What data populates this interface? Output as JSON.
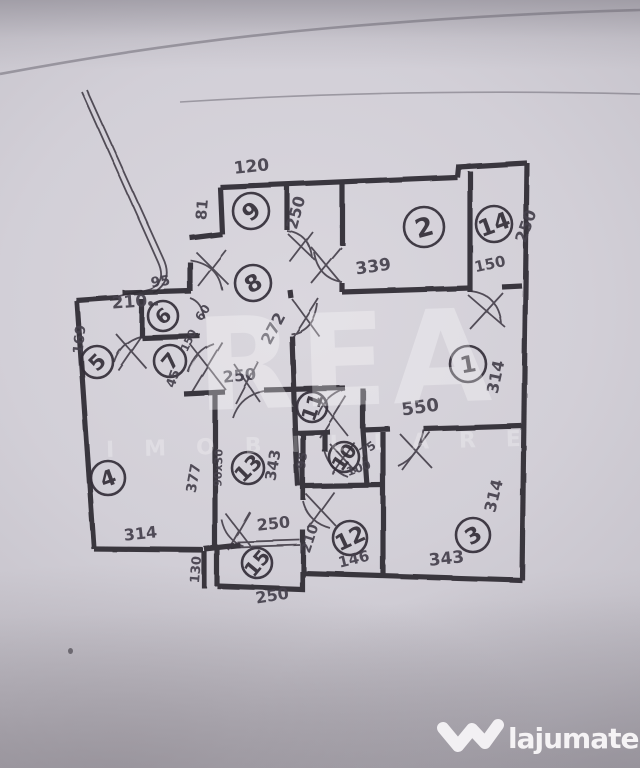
{
  "watermark": {
    "brand": "REA",
    "subtitle": "IMOBILIARE"
  },
  "logo": {
    "site": "lajumate",
    "tld": ".ro",
    "text_color": "#f5f3f5",
    "tld_color": "#b9ded6"
  },
  "floorplan": {
    "ink_color": "#332e38",
    "paper_color": "#cdcad2",
    "rooms": [
      {
        "n": "9",
        "x": 251,
        "y": 211,
        "r": 18,
        "rot": -40
      },
      {
        "n": "2",
        "x": 424,
        "y": 227,
        "r": 20,
        "rot": -15
      },
      {
        "n": "14",
        "x": 494,
        "y": 224,
        "r": 18,
        "rot": -20
      },
      {
        "n": "8",
        "x": 253,
        "y": 283,
        "r": 18,
        "rot": -30
      },
      {
        "n": "6",
        "x": 163,
        "y": 316,
        "r": 15,
        "rot": -40
      },
      {
        "n": "5",
        "x": 97,
        "y": 362,
        "r": 16,
        "rot": -45
      },
      {
        "n": "7",
        "x": 170,
        "y": 361,
        "r": 16,
        "rot": -50
      },
      {
        "n": "1",
        "x": 468,
        "y": 364,
        "r": 18,
        "rot": -10
      },
      {
        "n": "11",
        "x": 312,
        "y": 407,
        "r": 15,
        "rot": -70
      },
      {
        "n": "10",
        "x": 344,
        "y": 457,
        "r": 15,
        "rot": -55
      },
      {
        "n": "13",
        "x": 248,
        "y": 468,
        "r": 16,
        "rot": -45
      },
      {
        "n": "4",
        "x": 108,
        "y": 478,
        "r": 17,
        "rot": -20
      },
      {
        "n": "3",
        "x": 473,
        "y": 535,
        "r": 17,
        "rot": -30
      },
      {
        "n": "12",
        "x": 350,
        "y": 538,
        "r": 17,
        "rot": -25
      },
      {
        "n": "15",
        "x": 257,
        "y": 563,
        "r": 15,
        "rot": -50
      }
    ],
    "dimensions": [
      {
        "t": "120",
        "x": 252,
        "y": 172,
        "rot": -6,
        "s": 17
      },
      {
        "t": "81",
        "x": 207,
        "y": 210,
        "rot": -85,
        "s": 15
      },
      {
        "t": "250",
        "x": 301,
        "y": 214,
        "rot": -75,
        "s": 16
      },
      {
        "t": "250",
        "x": 531,
        "y": 228,
        "rot": -70,
        "s": 16
      },
      {
        "t": "150",
        "x": 491,
        "y": 269,
        "rot": -12,
        "s": 15
      },
      {
        "t": "339",
        "x": 374,
        "y": 272,
        "rot": -8,
        "s": 17
      },
      {
        "t": "272",
        "x": 278,
        "y": 331,
        "rot": -62,
        "s": 16
      },
      {
        "t": "60",
        "x": 206,
        "y": 315,
        "rot": -55,
        "s": 12
      },
      {
        "t": "95",
        "x": 161,
        "y": 286,
        "rot": -8,
        "s": 14
      },
      {
        "t": "210 .",
        "x": 136,
        "y": 307,
        "rot": -4,
        "s": 17
      },
      {
        "t": "169",
        "x": 84,
        "y": 340,
        "rot": -84,
        "s": 14
      },
      {
        "t": "150",
        "x": 192,
        "y": 342,
        "rot": -65,
        "s": 11
      },
      {
        "t": "45",
        "x": 177,
        "y": 380,
        "rot": -70,
        "s": 13
      },
      {
        "t": "250",
        "x": 240,
        "y": 381,
        "rot": -6,
        "s": 16
      },
      {
        "t": "550",
        "x": 421,
        "y": 413,
        "rot": -8,
        "s": 18
      },
      {
        "t": "314",
        "x": 501,
        "y": 378,
        "rot": -78,
        "s": 16
      },
      {
        "t": "314",
        "x": 499,
        "y": 497,
        "rot": -76,
        "s": 16
      },
      {
        "t": "343",
        "x": 447,
        "y": 564,
        "rot": -6,
        "s": 17
      },
      {
        "t": "95",
        "x": 306,
        "y": 461,
        "rot": -82,
        "s": 12
      },
      {
        "t": "75",
        "x": 370,
        "y": 452,
        "rot": -35,
        "s": 12
      },
      {
        "t": "100",
        "x": 360,
        "y": 472,
        "rot": -20,
        "s": 12
      },
      {
        "t": "343",
        "x": 278,
        "y": 466,
        "rot": -80,
        "s": 15
      },
      {
        "t": "90x30",
        "x": 222,
        "y": 468,
        "rot": -88,
        "s": 11
      },
      {
        "t": "377",
        "x": 198,
        "y": 479,
        "rot": -80,
        "s": 14
      },
      {
        "t": "314",
        "x": 141,
        "y": 539,
        "rot": -6,
        "s": 16
      },
      {
        "t": "130",
        "x": 200,
        "y": 570,
        "rot": -85,
        "s": 13
      },
      {
        "t": "250",
        "x": 274,
        "y": 529,
        "rot": -6,
        "s": 16
      },
      {
        "t": "210",
        "x": 314,
        "y": 540,
        "rot": -72,
        "s": 14
      },
      {
        "t": "146",
        "x": 355,
        "y": 564,
        "rot": -14,
        "s": 15
      },
      {
        "t": "250",
        "x": 273,
        "y": 601,
        "rot": -9,
        "s": 16
      }
    ]
  }
}
